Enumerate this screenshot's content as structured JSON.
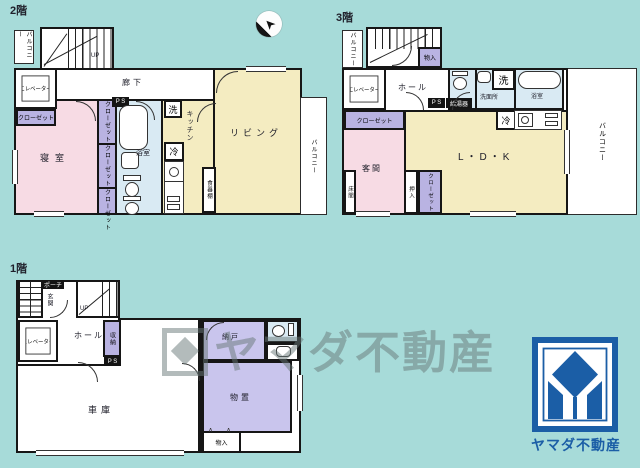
{
  "colors": {
    "bg": "#a7dbd9",
    "wall": "#161616",
    "pink": "#f7dbe4",
    "yellow": "#f4ecc1",
    "blue": "#d9eaf3",
    "purple": "#b9b3e2",
    "purple2": "#c9c5ed",
    "brand": "#1b5ea6",
    "watermark_gray": "#687878"
  },
  "icons": {
    "compass_arrow": "➤",
    "folding_door": "∧"
  },
  "common": {
    "balcony": "バルコニー",
    "closet": "クローゼット",
    "elevator": "エレベーター",
    "hall": "ホール",
    "monoire": "物入",
    "ps": "P S",
    "up": "UP",
    "washer": "洗",
    "fridge": "冷",
    "bathroom": "浴室"
  },
  "floor2": {
    "title": "2階",
    "corridor": "廊下",
    "bedroom": "寝室",
    "kitchen": "キッチン",
    "cupboard": "食器棚",
    "living": "リビング"
  },
  "floor3": {
    "title": "3階",
    "washroom": "洗面所",
    "water_heater": "給湯器",
    "ldk": "L・D・K",
    "guest_room": "客間",
    "tokonoma": "床間",
    "oshiire": "押入"
  },
  "floor1": {
    "title": "1階",
    "porch": "ポーチ",
    "entrance": "玄関",
    "storage": "収納",
    "garage": "車庫",
    "nando": "納戸",
    "monooki": "物置"
  },
  "watermark": {
    "text": "ヤマダ不動産"
  },
  "brand": {
    "name": "ヤマダ不動産"
  }
}
